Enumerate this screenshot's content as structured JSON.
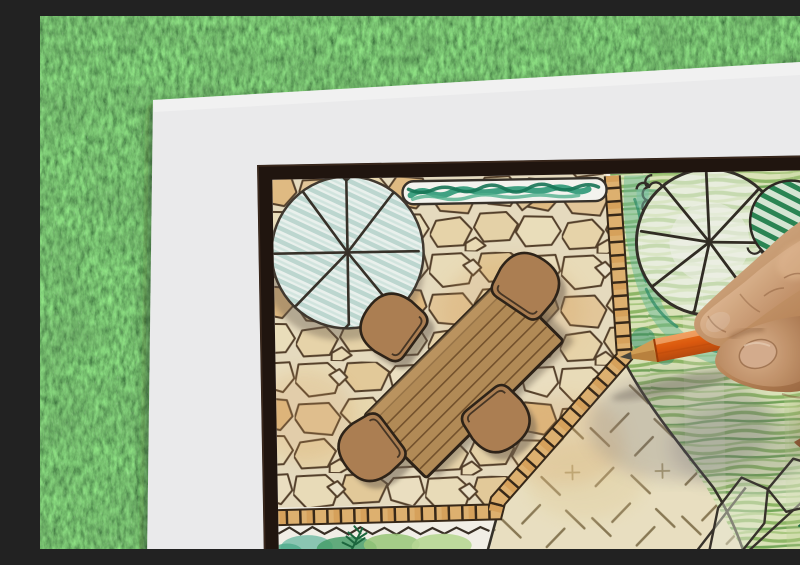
{
  "scene": {
    "description": "Overhead photo of a designer's hand drawing a backyard garden landscape plan with an orange colored pencil; the white plan sheet with a dark frame border lies on green grass",
    "medium": "colored pencil and marker on paper",
    "background_surface": "green grass lawn",
    "sheet": "white paper sheet",
    "frame": "dark wood border around the plan"
  },
  "plan": {
    "elements": [
      {
        "name": "flagstone-patio",
        "style": "irregular tan flagstones with dark brown joints"
      },
      {
        "name": "hedge-row",
        "style": "rounded rectangle with teal-green scribble"
      },
      {
        "name": "shade-tree-left",
        "style": "large circle, light teal diagonal stripes, radiating branch spokes"
      },
      {
        "name": "dining-table",
        "style": "rectangular wood-plank table",
        "seats": 4
      },
      {
        "name": "chairs",
        "count": 4,
        "style": "rounded-back seats"
      },
      {
        "name": "brick-border",
        "style": "small rectangular pavers edging the patio"
      },
      {
        "name": "lawn",
        "style": "yellow-green horizontal crayon strokes"
      },
      {
        "name": "shade-tree-right",
        "style": "spoked canopy circle with scalloped shrub edge"
      },
      {
        "name": "striped-shrub",
        "style": "dark green diagonal hatched blob"
      },
      {
        "name": "gravel-area",
        "style": "cream field with dashed tick marks"
      },
      {
        "name": "planting-bed-bottom",
        "style": "teal and green watercolor shrubs with dark fern"
      },
      {
        "name": "rock-cluster",
        "location": "bottom-right"
      },
      {
        "name": "flower-patch",
        "location": "bottom-right corner",
        "colors": [
          "orange",
          "green"
        ]
      }
    ]
  },
  "foreground": {
    "hand": "right hand gripping pencil",
    "pencil": {
      "color_name": "orange",
      "tip": "sharpened wood cone with dark lead"
    }
  },
  "palette": {
    "grass": "#4e7a40",
    "paper": "#f4f4f5",
    "frame": "#241812",
    "stone_fill": "#f0e0b8",
    "stone_line": "#57422c",
    "brick": "#e6b874",
    "wood_furniture": "#b9905a",
    "hedge_teal": "#2f9e7b",
    "lawn_stroke": "#8cba62",
    "tree_stripe": "#c4dfd8",
    "shrub_green": "#2c8a57",
    "pencil_orange": "#fb7d1f",
    "skin": "#c08b5d"
  }
}
